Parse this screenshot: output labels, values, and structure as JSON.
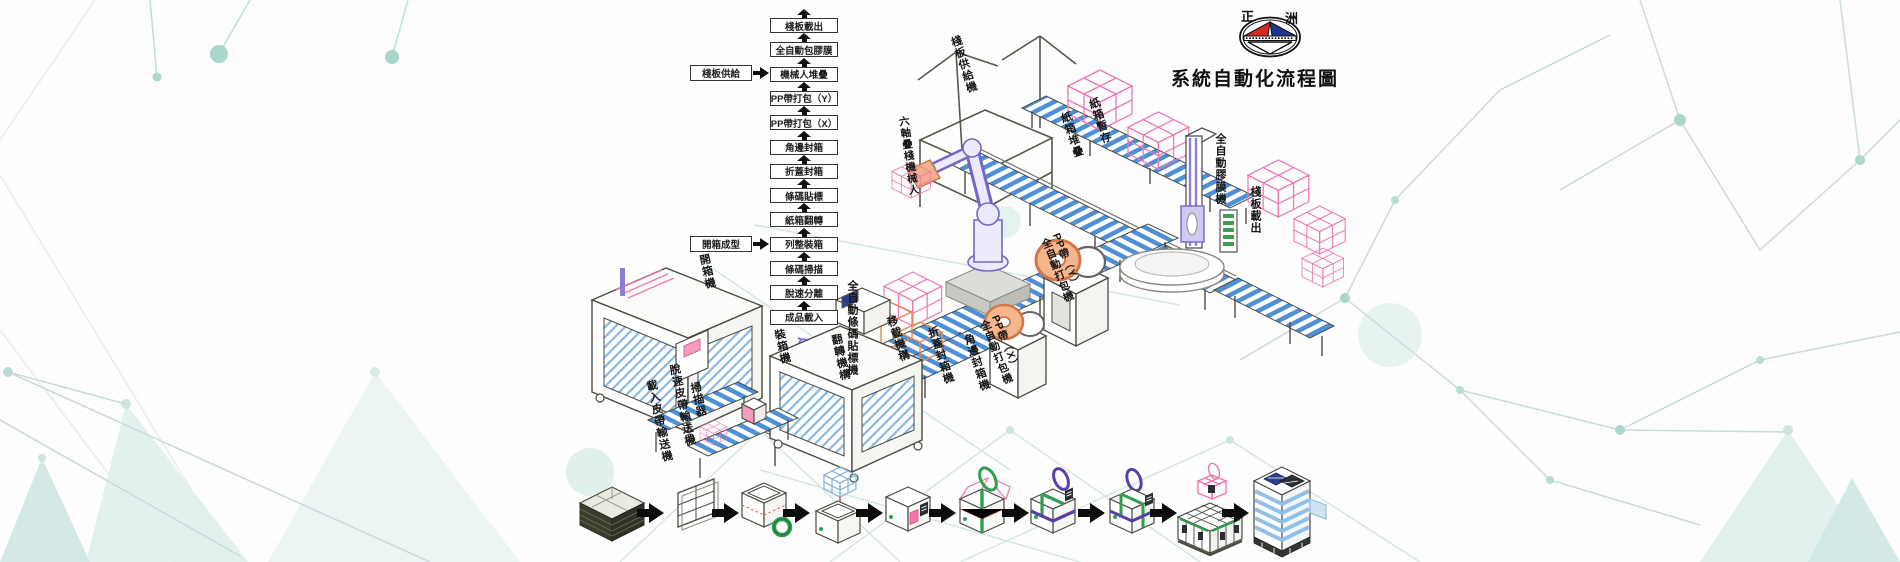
{
  "title": {
    "text": "系統自動化流程圖"
  },
  "logo": {
    "left_char": "正",
    "right_char": "洲"
  },
  "colors": {
    "background": "#fdfdfd",
    "decor_teal_dot": "#a9d7cb",
    "decor_triangle": "#ddeeeb",
    "conveyor_blue": "#4d90d5",
    "wireframe_pink": "#f076b2",
    "robot_purple": "#7468c4",
    "strap_green": "#2f9e4f",
    "strap_purple": "#5b3fa8",
    "coil_orange": "#f0a97e",
    "logo_red": "#d42b26",
    "logo_blue": "#20368c",
    "line_dark": "#4b4b43"
  },
  "flowchart": {
    "steps": [
      {
        "label": "棧板載出"
      },
      {
        "label": "全自動包膠膜"
      },
      {
        "label": "機械人堆疊"
      },
      {
        "label": "PP帶打包（Y）"
      },
      {
        "label": "PP帶打包（X）"
      },
      {
        "label": "角邊封箱"
      },
      {
        "label": "折蓋封箱"
      },
      {
        "label": "條碼貼標"
      },
      {
        "label": "紙箱翻轉"
      },
      {
        "label": "列整裝箱"
      },
      {
        "label": "條碼掃描"
      },
      {
        "label": "脫速分離"
      },
      {
        "label": "成品載入"
      }
    ],
    "side_labels": [
      {
        "label": "棧板供給",
        "attaches_to": "機械人堆疊"
      },
      {
        "label": "開箱成型",
        "attaches_to": "列整裝箱"
      }
    ]
  },
  "machine_labels": [
    {
      "line1": "棧板供給機"
    },
    {
      "line1": "紙箱堆疊"
    },
    {
      "line1": "紙箱暫存"
    },
    {
      "line1": "全自動膠膜機"
    },
    {
      "line1": "棧板載出"
    },
    {
      "line1": "六軸疊棧機械人"
    },
    {
      "line1": "PP帶（Y）",
      "line2": "全自動打包機"
    },
    {
      "line1": "PP帶（X）",
      "line2": "全自動打包機"
    },
    {
      "line1": "角邊封箱機"
    },
    {
      "line1": "折蓋封箱機"
    },
    {
      "line1": "移載機構"
    },
    {
      "line1": "全自動條碼貼標機"
    },
    {
      "line1": "翻轉機構"
    },
    {
      "line1": "裝箱機"
    },
    {
      "line1": "開箱機"
    },
    {
      "line1": "掃描器"
    },
    {
      "line1": "脫速皮帶輸送機"
    },
    {
      "line1": "載入皮帶輸送機"
    }
  ],
  "process_stages": [
    {
      "name": "flat-carton-stack"
    },
    {
      "name": "carton-blank"
    },
    {
      "name": "box-forming-taping"
    },
    {
      "name": "product-loading"
    },
    {
      "name": "box-labeling"
    },
    {
      "name": "strapping-y"
    },
    {
      "name": "strapping-x"
    },
    {
      "name": "strapped-box"
    },
    {
      "name": "palletizing"
    },
    {
      "name": "pallet-wrapping"
    }
  ]
}
